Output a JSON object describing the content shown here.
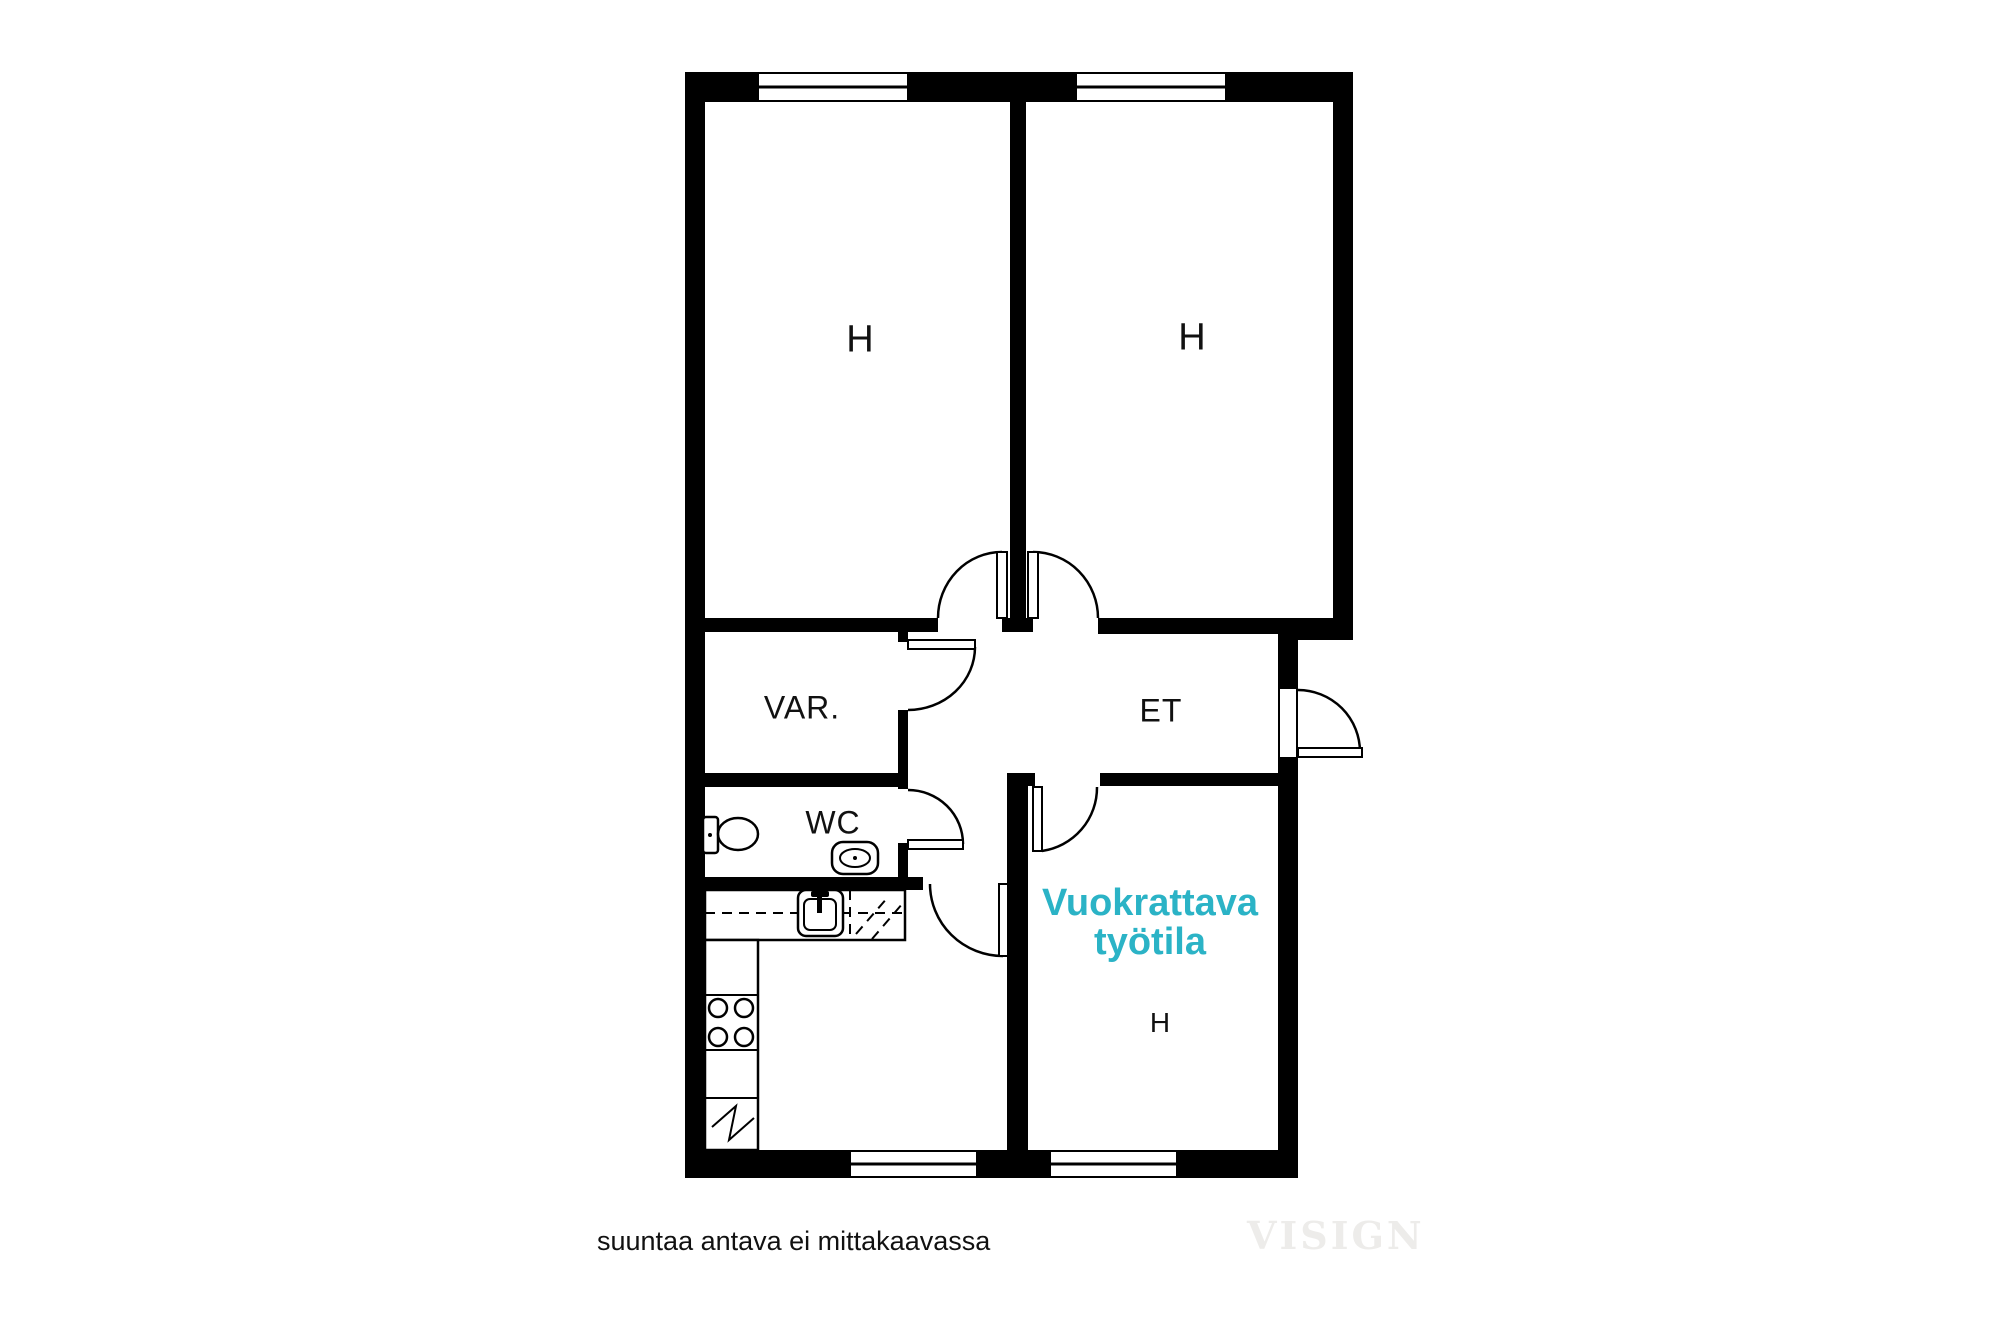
{
  "page": {
    "footnote": "suuntaa antava ei mittakaavassa",
    "watermark": "VISIGN"
  },
  "plan": {
    "rooms": {
      "room_top_left": "H",
      "room_top_right": "H",
      "storage": "VAR.",
      "wc": "WC",
      "entry_hall": "ET",
      "workspace_room": "H"
    },
    "workspace_highlight": {
      "line1": "Vuokrattava",
      "line2": "työtila"
    },
    "fixtures": [
      "toilet-icon",
      "wc-sink-icon",
      "kitchen-sink-icon",
      "stove-icon",
      "fridge-icon",
      "window-symbol",
      "door-swing-symbol"
    ],
    "colors": {
      "wall": "#000000",
      "background": "#ffffff",
      "accent": "#2bb3c6",
      "text": "#111111",
      "watermark": "#edecea"
    }
  }
}
